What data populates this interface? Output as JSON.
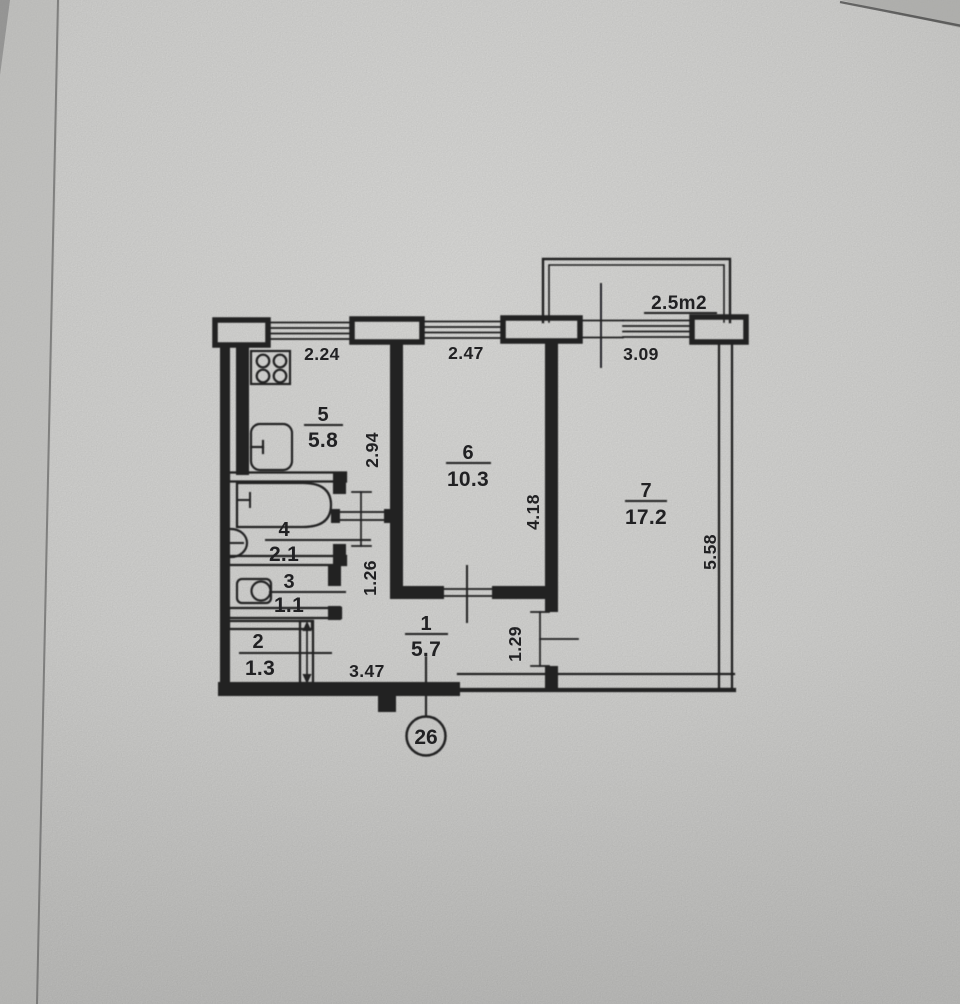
{
  "plan": {
    "title": "apartment floor plan (scanned)",
    "apartment_number": "26",
    "balcony": {
      "area": "2.5m2"
    },
    "rooms": [
      {
        "id": "hallway",
        "num": "1",
        "area": "5.7"
      },
      {
        "id": "closet",
        "num": "2",
        "area": "1.3"
      },
      {
        "id": "wc",
        "num": "3",
        "area": "1.1"
      },
      {
        "id": "bathroom",
        "num": "4",
        "area": "2.1"
      },
      {
        "id": "kitchen",
        "num": "5",
        "area": "5.8"
      },
      {
        "id": "room6",
        "num": "6",
        "area": "10.3"
      },
      {
        "id": "room7",
        "num": "7",
        "area": "17.2"
      }
    ],
    "dimensions": {
      "kitchen_window": "2.24",
      "room6_window": "2.47",
      "balcony_front": "3.09",
      "kitchen_depth": "2.94",
      "room6_depth": "4.18",
      "room7_depth": "5.58",
      "corridor_width": "1.26",
      "room7_door": "1.29",
      "hall_length": "3.47"
    }
  },
  "colors": {
    "paper": "#d8d8d6",
    "ink": "#212123"
  }
}
